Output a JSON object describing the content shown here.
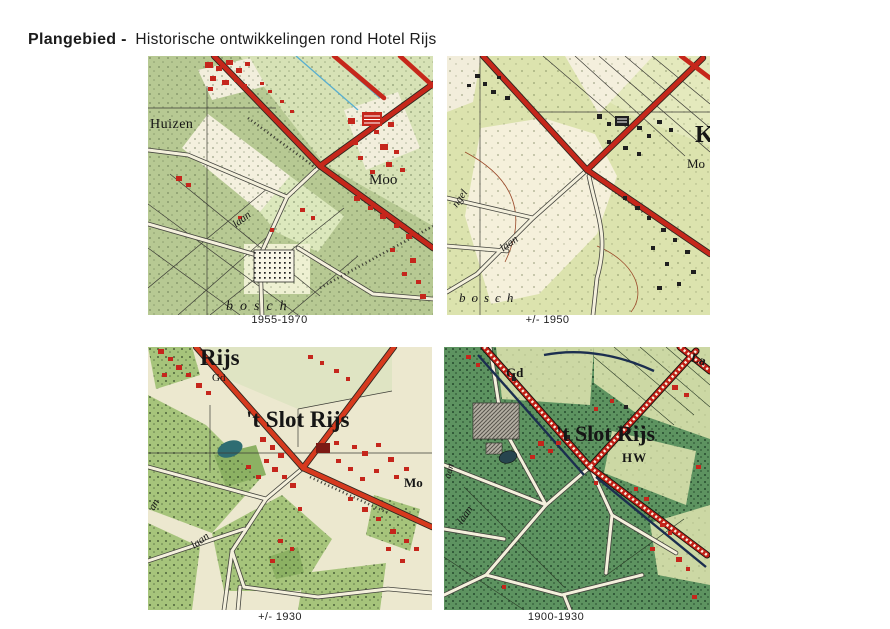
{
  "title": {
    "lead": "Plangebied -",
    "rest": "Historische ontwikkelingen rond Hotel Rijs"
  },
  "maps": [
    {
      "caption": "1955-1970",
      "labels": {
        "settlement": "Huizen",
        "place_right": "Moo",
        "lane": "laan",
        "forest": "bosch"
      }
    },
    {
      "caption": "+/- 1950",
      "labels": {
        "lane_left": "ngel",
        "lane": "laan",
        "forest": "bosch",
        "place_right": "Mo",
        "corner_letter": "K"
      }
    },
    {
      "caption": "+/- 1930",
      "labels": {
        "place_top": "Rijs",
        "parcel": "Gd",
        "estate": "'t Slot Rijs",
        "place_right": "Mo",
        "lane": "laan",
        "lane_left": "an"
      }
    },
    {
      "caption": "1900-1930",
      "labels": {
        "parcel": "Gd",
        "estate": "'t Slot Rijs",
        "marker": "HW",
        "lane": "laan",
        "lane_left": "aan",
        "corner": "La"
      }
    }
  ],
  "palette": {
    "road_red": "#c6271b",
    "road_orange_red": "#d63a1e",
    "checkered_road_red": "#c21f15",
    "mid_green": "#b7c993",
    "pale_green_1950": "#dce3ae",
    "woods_green_1930": "#a6c47b",
    "woods_green_1900": "#5d9360",
    "field_cream": "#f3eedb",
    "canal_navy": "#1b2e4f",
    "water_blue": "#58aed0",
    "ink": "#1b1b1b"
  }
}
